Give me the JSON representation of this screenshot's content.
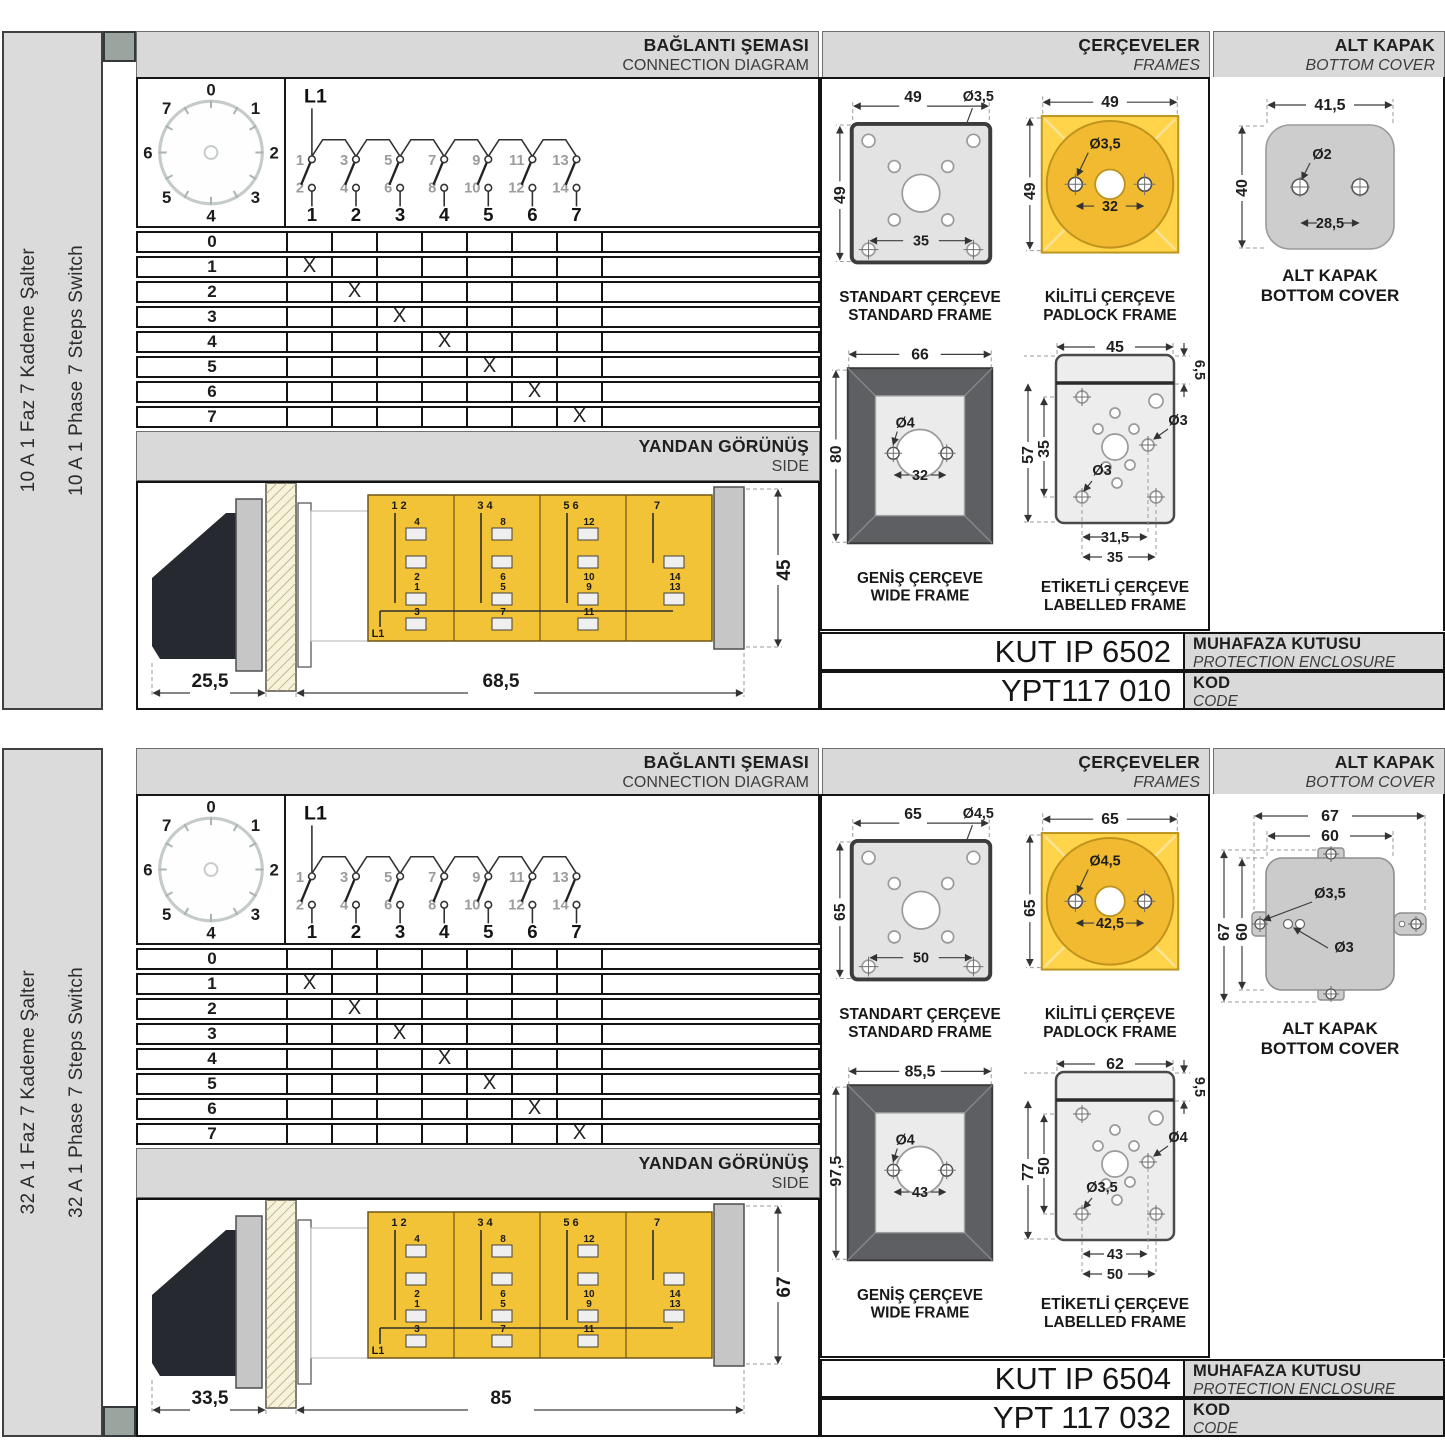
{
  "panel1": {
    "sidebar": {
      "tr": "10 A 1 Faz 7 Kademe Şalter",
      "en": "10 A 1 Phase 7 Steps Switch"
    },
    "marker_position": "top",
    "headers": {
      "connection_tr": "BAĞLANTI ŞEMASI",
      "connection_en": "CONNECTION DIAGRAM",
      "frames_tr": "ÇERÇEVELER",
      "frames_en": "FRAMES",
      "cover_tr": "ALT KAPAK",
      "cover_en": "BOTTOM COVER",
      "side_tr": "YANDAN GÖRÜNÜŞ",
      "side_en": "SIDE"
    },
    "dial": {
      "positions": [
        "0",
        "1",
        "2",
        "3",
        "4",
        "5",
        "6",
        "7"
      ]
    },
    "diagram": {
      "phase": "L1",
      "top_nums": [
        "1",
        "3",
        "5",
        "7",
        "9",
        "11",
        "13"
      ],
      "bottom_nums": [
        "2",
        "4",
        "6",
        "8",
        "10",
        "12",
        "14"
      ],
      "switch_nums": [
        "1",
        "2",
        "3",
        "4",
        "5",
        "6",
        "7"
      ]
    },
    "table": {
      "rows": [
        {
          "label": "0",
          "m": [
            "",
            "",
            "",
            "",
            "",
            "",
            ""
          ]
        },
        {
          "label": "1",
          "m": [
            "X",
            "",
            "",
            "",
            "",
            "",
            ""
          ]
        },
        {
          "label": "2",
          "m": [
            "",
            "X",
            "",
            "",
            "",
            "",
            ""
          ]
        },
        {
          "label": "3",
          "m": [
            "",
            "",
            "X",
            "",
            "",
            "",
            ""
          ]
        },
        {
          "label": "4",
          "m": [
            "",
            "",
            "",
            "X",
            "",
            "",
            ""
          ]
        },
        {
          "label": "5",
          "m": [
            "",
            "",
            "",
            "",
            "X",
            "",
            ""
          ]
        },
        {
          "label": "6",
          "m": [
            "",
            "",
            "",
            "",
            "",
            "X",
            ""
          ]
        },
        {
          "label": "7",
          "m": [
            "",
            "",
            "",
            "",
            "",
            "",
            "X"
          ]
        }
      ]
    },
    "side_view": {
      "input": "L1",
      "dim_front": "25,5",
      "dim_body": "68,5",
      "dim_height": "45",
      "cassettes": [
        {
          "pair": "1 2",
          "up_top": "4",
          "up_bottom": "2",
          "low_a": "1",
          "low_b": "3"
        },
        {
          "pair": "3 4",
          "up_top": "8",
          "up_bottom": "6",
          "low_a": "5",
          "low_b": "7"
        },
        {
          "pair": "5 6",
          "up_top": "12",
          "up_bottom": "10",
          "low_a": "9",
          "low_b": "11"
        },
        {
          "pair": "7",
          "up_bottom": "14",
          "low_a": "13"
        }
      ]
    },
    "frames": {
      "standard": {
        "t1": "STANDART ÇERÇEVE",
        "t2": "STANDARD FRAME",
        "w": "49",
        "h": "49",
        "hole": "Ø3,5",
        "inner": "35"
      },
      "padlock": {
        "t1": "KİLİTLİ ÇERÇEVE",
        "t2": "PADLOCK FRAME",
        "w": "49",
        "h": "49",
        "hole": "Ø3,5",
        "inner": "32"
      },
      "wide": {
        "t1": "GENİŞ ÇERÇEVE",
        "t2": "WIDE FRAME",
        "w": "66",
        "h": "80",
        "hole": "Ø4",
        "inner": "32"
      },
      "labelled": {
        "t1": "ETİKETLİ ÇERÇEVE",
        "t2": "LABELLED FRAME",
        "w": "45",
        "tab": "6,5",
        "h": "57",
        "ih": "35",
        "hole_r": "Ø3",
        "hole_b": "Ø3",
        "iw1": "31,5",
        "iw2": "35"
      }
    },
    "cover": {
      "variant": "plain",
      "t1": "ALT KAPAK",
      "t2": "BOTTOM COVER",
      "w": "41,5",
      "h": "40",
      "hole": "Ø2",
      "inner": "28,5"
    },
    "codes": {
      "box": "KUT IP 6502",
      "box_tr": "MUHAFAZA KUTUSU",
      "box_en": "PROTECTION ENCLOSURE",
      "code": "YPT117 010",
      "code_tr": "KOD",
      "code_en": "CODE"
    }
  },
  "panel2": {
    "sidebar": {
      "tr": "32 A 1 Faz 7 Kademe Şalter",
      "en": "32 A 1 Phase 7 Steps Switch"
    },
    "marker_position": "bottom",
    "headers": {
      "connection_tr": "BAĞLANTI ŞEMASI",
      "connection_en": "CONNECTION DIAGRAM",
      "frames_tr": "ÇERÇEVELER",
      "frames_en": "FRAMES",
      "cover_tr": "ALT KAPAK",
      "cover_en": "BOTTOM COVER",
      "side_tr": "YANDAN GÖRÜNÜŞ",
      "side_en": "SIDE"
    },
    "dial": {
      "positions": [
        "0",
        "1",
        "2",
        "3",
        "4",
        "5",
        "6",
        "7"
      ]
    },
    "diagram": {
      "phase": "L1",
      "top_nums": [
        "1",
        "3",
        "5",
        "7",
        "9",
        "11",
        "13"
      ],
      "bottom_nums": [
        "2",
        "4",
        "6",
        "8",
        "10",
        "12",
        "14"
      ],
      "switch_nums": [
        "1",
        "2",
        "3",
        "4",
        "5",
        "6",
        "7"
      ]
    },
    "table": {
      "rows": [
        {
          "label": "0",
          "m": [
            "",
            "",
            "",
            "",
            "",
            "",
            ""
          ]
        },
        {
          "label": "1",
          "m": [
            "X",
            "",
            "",
            "",
            "",
            "",
            ""
          ]
        },
        {
          "label": "2",
          "m": [
            "",
            "X",
            "",
            "",
            "",
            "",
            ""
          ]
        },
        {
          "label": "3",
          "m": [
            "",
            "",
            "X",
            "",
            "",
            "",
            ""
          ]
        },
        {
          "label": "4",
          "m": [
            "",
            "",
            "",
            "X",
            "",
            "",
            ""
          ]
        },
        {
          "label": "5",
          "m": [
            "",
            "",
            "",
            "",
            "X",
            "",
            ""
          ]
        },
        {
          "label": "6",
          "m": [
            "",
            "",
            "",
            "",
            "",
            "X",
            ""
          ]
        },
        {
          "label": "7",
          "m": [
            "",
            "",
            "",
            "",
            "",
            "",
            "X"
          ]
        }
      ]
    },
    "side_view": {
      "input": "L1",
      "dim_front": "33,5",
      "dim_body": "85",
      "dim_height": "67",
      "cassettes": [
        {
          "pair": "1 2",
          "up_top": "4",
          "up_bottom": "2",
          "low_a": "1",
          "low_b": "3"
        },
        {
          "pair": "3 4",
          "up_top": "8",
          "up_bottom": "6",
          "low_a": "5",
          "low_b": "7"
        },
        {
          "pair": "5 6",
          "up_top": "12",
          "up_bottom": "10",
          "low_a": "9",
          "low_b": "11"
        },
        {
          "pair": "7",
          "up_bottom": "14",
          "low_a": "13"
        }
      ]
    },
    "frames": {
      "standard": {
        "t1": "STANDART ÇERÇEVE",
        "t2": "STANDARD FRAME",
        "w": "65",
        "h": "65",
        "hole": "Ø4,5",
        "inner": "50"
      },
      "padlock": {
        "t1": "KİLİTLİ ÇERÇEVE",
        "t2": "PADLOCK FRAME",
        "w": "65",
        "h": "65",
        "hole": "Ø4,5",
        "inner": "42,5"
      },
      "wide": {
        "t1": "GENİŞ ÇERÇEVE",
        "t2": "WIDE FRAME",
        "w": "85,5",
        "h": "97,5",
        "hole": "Ø4",
        "inner": "43"
      },
      "labelled": {
        "t1": "ETİKETLİ ÇERÇEVE",
        "t2": "LABELLED FRAME",
        "w": "62",
        "tab": "9,5",
        "h": "77",
        "ih": "50",
        "hole_r": "Ø4",
        "hole_b": "Ø3,5",
        "iw1": "43",
        "iw2": "50"
      }
    },
    "cover": {
      "variant": "tabs",
      "t1": "ALT KAPAK",
      "t2": "BOTTOM COVER",
      "w_out": "67",
      "w_in": "60",
      "h_out": "67",
      "h_in": "60",
      "hole1": "Ø3,5",
      "hole2": "Ø3"
    },
    "codes": {
      "box": "KUT IP 6504",
      "box_tr": "MUHAFAZA KUTUSU",
      "box_en": "PROTECTION ENCLOSURE",
      "code": "YPT 117 032",
      "code_tr": "KOD",
      "code_en": "CODE"
    }
  }
}
